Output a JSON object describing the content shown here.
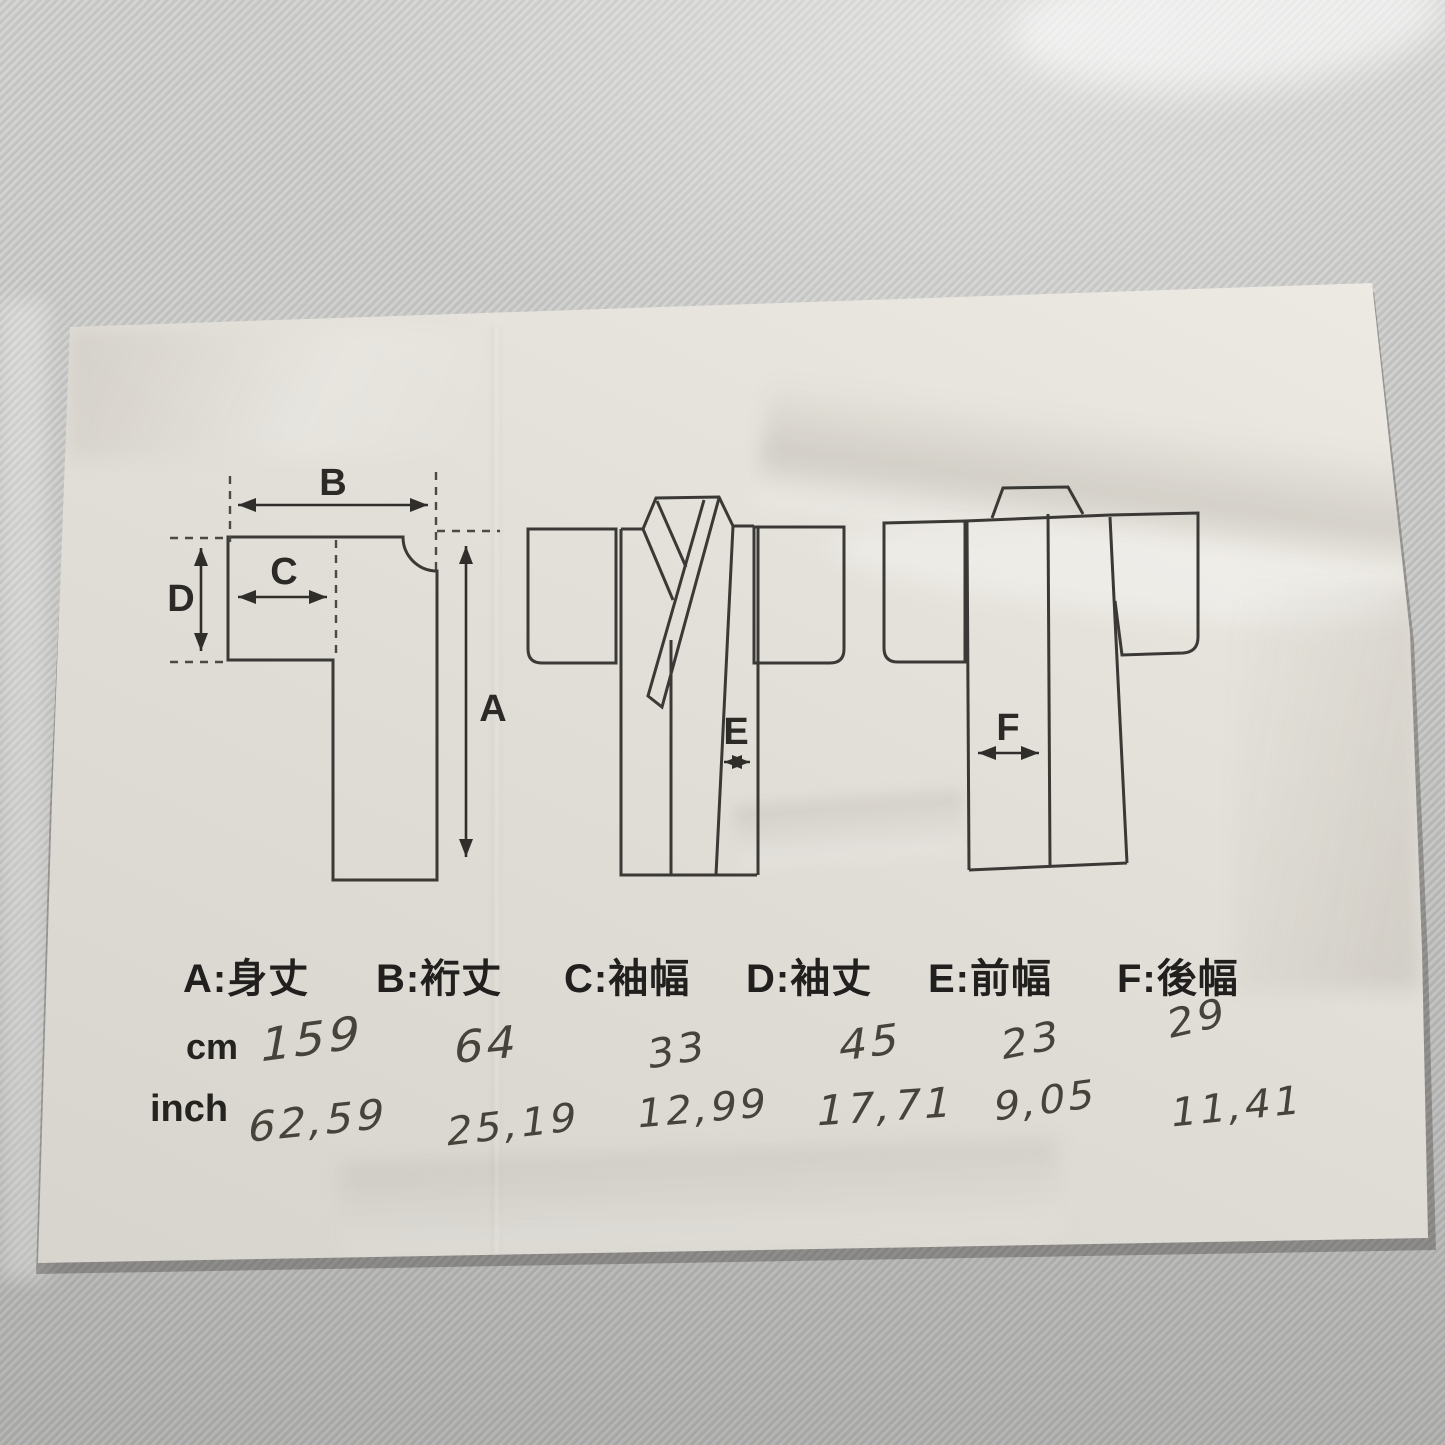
{
  "measurements": [
    {
      "letter": "A",
      "name_jp": "身丈",
      "legend_text": "A:身丈",
      "cm": "159",
      "inch": "62,59"
    },
    {
      "letter": "B",
      "name_jp": "裄丈",
      "legend_text": "B:裄丈",
      "cm": "64",
      "inch": "25,19"
    },
    {
      "letter": "C",
      "name_jp": "袖幅",
      "legend_text": "C:袖幅",
      "cm": "33",
      "inch": "12,99"
    },
    {
      "letter": "D",
      "name_jp": "袖丈",
      "legend_text": "D:袖丈",
      "cm": "45",
      "inch": "17,71"
    },
    {
      "letter": "E",
      "name_jp": "前幅",
      "legend_text": "E:前幅",
      "cm": "23",
      "inch": "9,05"
    },
    {
      "letter": "F",
      "name_jp": "後幅",
      "legend_text": "F:後幅",
      "cm": "29",
      "inch": "11,41"
    }
  ],
  "units": {
    "cm_label": "cm",
    "inch_label": "inch"
  },
  "colors": {
    "paper": "#e6e3dc",
    "fabric": "#c7c7c5",
    "print_ink": "#3a3936",
    "pen_ink": "#46433b"
  }
}
